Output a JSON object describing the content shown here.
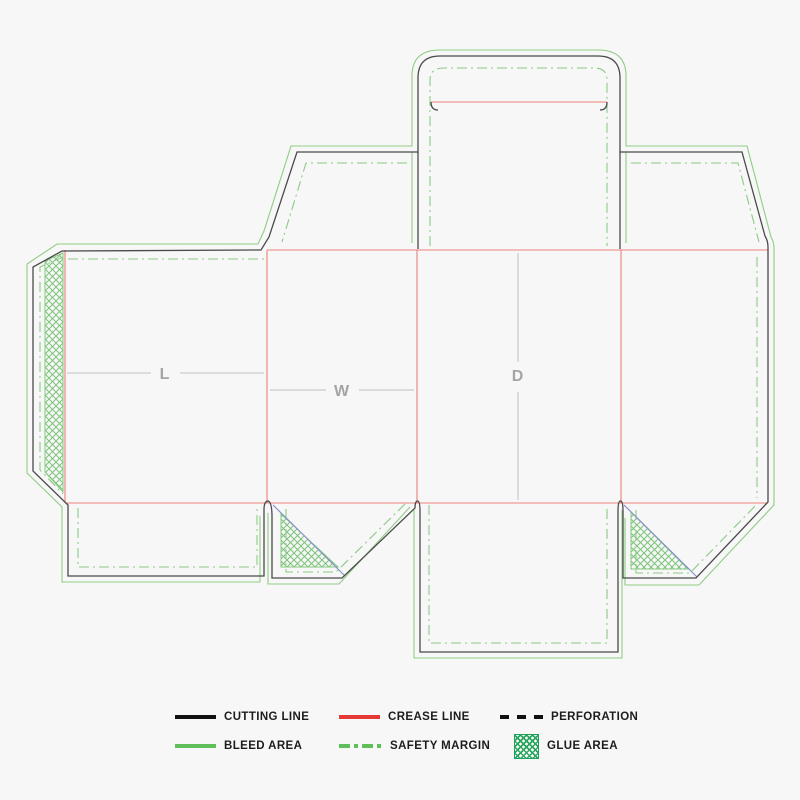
{
  "diagram": {
    "type": "packaging-dieline-box-template",
    "panel_labels": {
      "length": "L",
      "width": "W",
      "depth": "D"
    },
    "colors": {
      "background": "#f7f7f7",
      "cutting_line": "#4a4a4a",
      "crease_line": "#ee8179",
      "bleed_line": "#90cc85",
      "safety_margin_line": "#8cc985",
      "glue_hatch": "#7cc47a",
      "fold_line_blue": "#8793c9",
      "dimension_line": "#c2c2c2",
      "dimension_label": "#a5a5a5"
    }
  },
  "legend": {
    "items": [
      {
        "key": "cutting-line",
        "label": "CUTTING LINE",
        "color": "#111111"
      },
      {
        "key": "crease-line",
        "label": "CREASE LINE",
        "color": "#e53935"
      },
      {
        "key": "perforation",
        "label": "PERFORATION",
        "color": "#111111"
      },
      {
        "key": "bleed-area",
        "label": "BLEED AREA",
        "color": "#5fbf5a"
      },
      {
        "key": "safety-margin",
        "label": "SAFETY MARGIN",
        "color": "#5fbf5a"
      },
      {
        "key": "glue-area",
        "label": "GLUE AREA",
        "color": "#27a35f"
      }
    ]
  }
}
